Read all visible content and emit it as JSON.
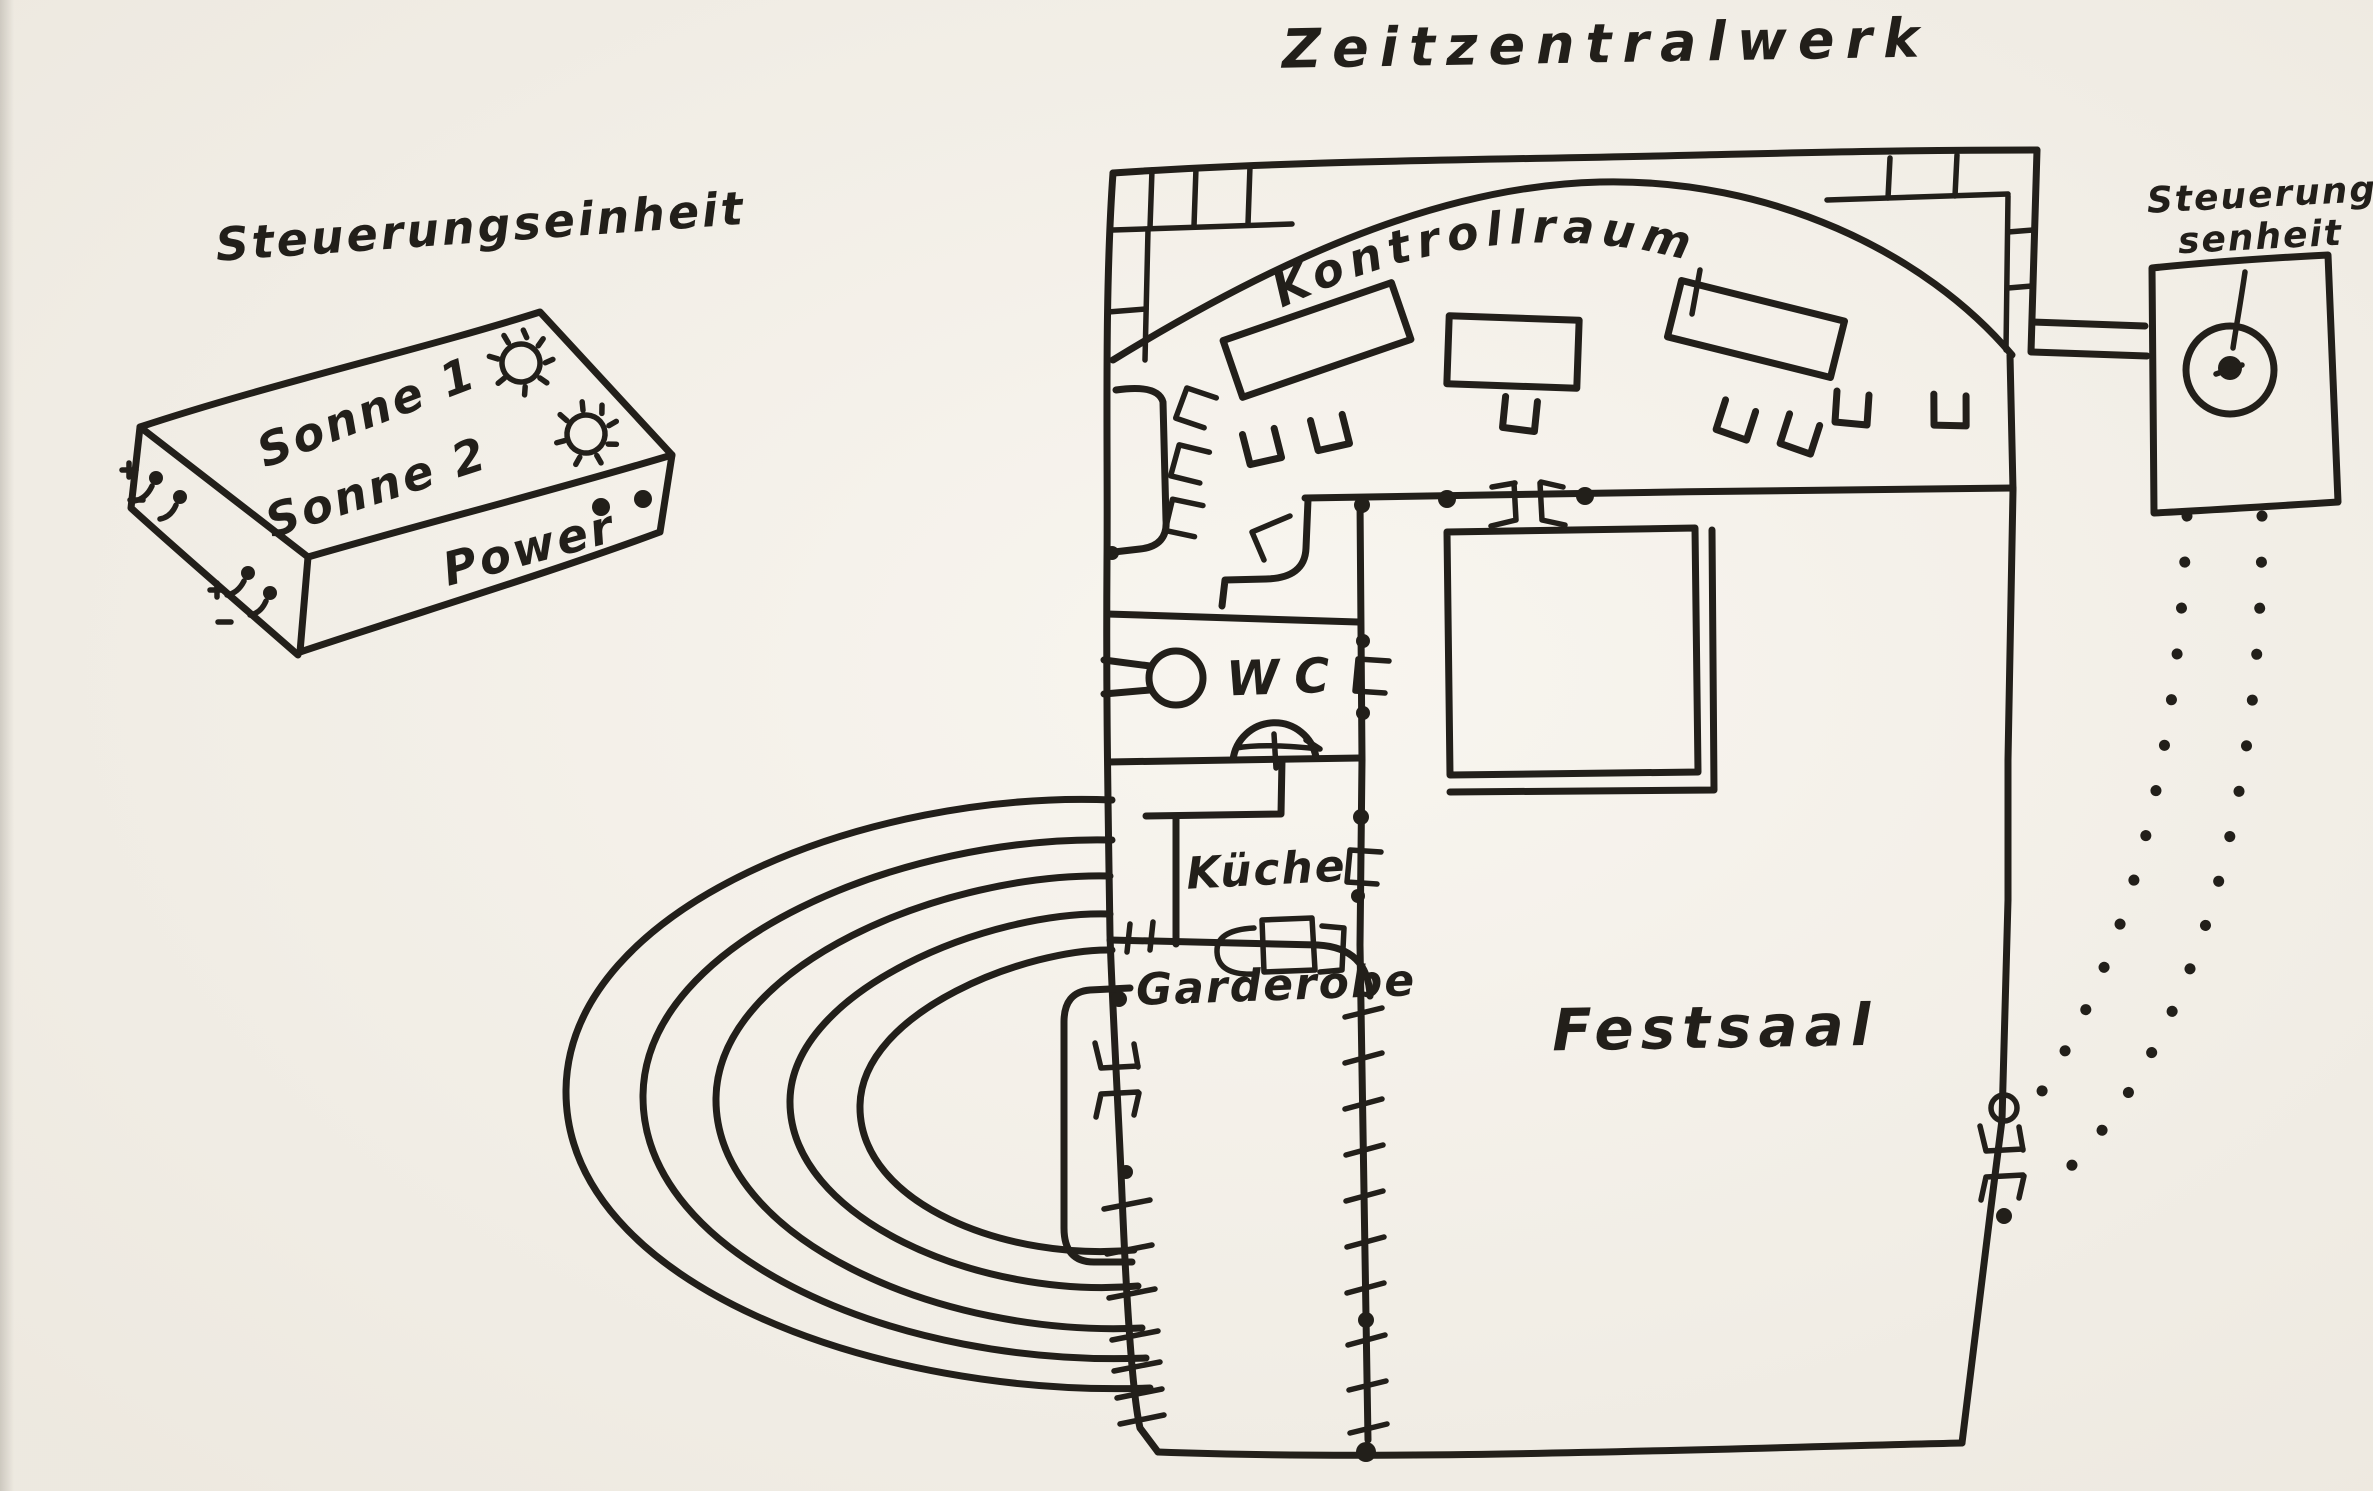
{
  "title": "Zeitzentralwerk",
  "colors": {
    "ink": "#221f1a",
    "paper": "#f6f2ea"
  },
  "left_control_unit": {
    "label": "Steuerungseinheit",
    "sonne1": "Sonne 1",
    "sonne2": "Sonne 2",
    "power": "Power"
  },
  "right_control_unit": {
    "label_line1": "Steuerung-",
    "label_line2": "senheit"
  },
  "floor_plan": {
    "control_room": "Kontrollraum",
    "wc": "WC",
    "kitchen": "Küche",
    "cloakroom": "Garderobe",
    "hall": "Festsaal"
  }
}
